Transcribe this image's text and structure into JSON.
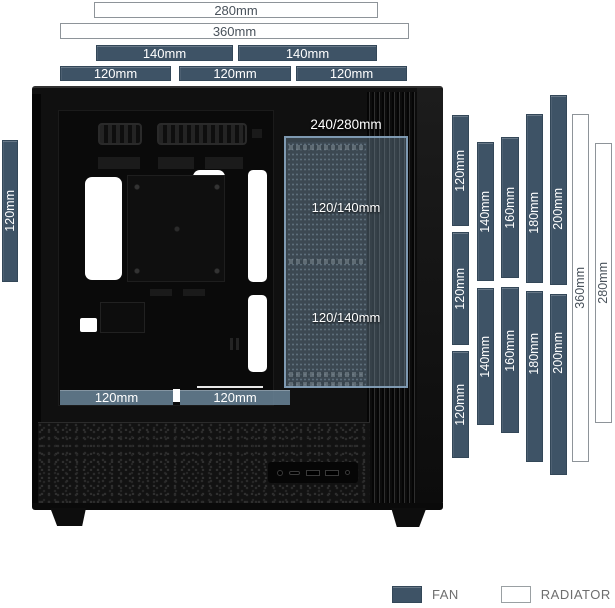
{
  "legend": {
    "fan_label": "FAN",
    "radiator_label": "RADIATOR"
  },
  "case_labels": {
    "side_radiator": "240/280mm",
    "side_fan_top": "120/140mm",
    "side_fan_bottom": "120/140mm"
  },
  "colors": {
    "fan_bar": "#3e5366",
    "radiator_border": "#8e9499",
    "bar_text_light": "#ffffff",
    "bar_text_dark": "#49525b",
    "overlay_tint": "rgba(124,152,173,0.38)",
    "legend_text": "#6e6e6e"
  },
  "dimension_bars": [
    {
      "label": "280mm",
      "kind": "radiator",
      "orient": "h",
      "x": 94,
      "y": 2,
      "w": 284,
      "h": 16,
      "area": "top"
    },
    {
      "label": "360mm",
      "kind": "radiator",
      "orient": "h",
      "x": 60,
      "y": 23,
      "w": 349,
      "h": 16,
      "area": "top"
    },
    {
      "label": "140mm",
      "kind": "fan",
      "orient": "h",
      "x": 96,
      "y": 45,
      "w": 137,
      "h": 16,
      "area": "top"
    },
    {
      "label": "140mm",
      "kind": "fan",
      "orient": "h",
      "x": 238,
      "y": 45,
      "w": 139,
      "h": 16,
      "area": "top"
    },
    {
      "label": "120mm",
      "kind": "fan",
      "orient": "h",
      "x": 60,
      "y": 66,
      "w": 111,
      "h": 15,
      "area": "top"
    },
    {
      "label": "120mm",
      "kind": "fan",
      "orient": "h",
      "x": 179,
      "y": 66,
      "w": 112,
      "h": 15,
      "area": "top"
    },
    {
      "label": "120mm",
      "kind": "fan",
      "orient": "h",
      "x": 296,
      "y": 66,
      "w": 111,
      "h": 15,
      "area": "top"
    },
    {
      "label": "120mm",
      "kind": "fan",
      "orient": "v",
      "x": 2,
      "y": 140,
      "w": 16,
      "h": 142,
      "area": "rear"
    },
    {
      "label": "120mm",
      "kind": "fan",
      "orient": "v",
      "x": 452,
      "y": 115,
      "w": 17,
      "h": 111,
      "area": "right"
    },
    {
      "label": "120mm",
      "kind": "fan",
      "orient": "v",
      "x": 452,
      "y": 232,
      "w": 17,
      "h": 113,
      "area": "right"
    },
    {
      "label": "120mm",
      "kind": "fan",
      "orient": "v",
      "x": 452,
      "y": 351,
      "w": 17,
      "h": 107,
      "area": "right"
    },
    {
      "label": "140mm",
      "kind": "fan",
      "orient": "v",
      "x": 477,
      "y": 142,
      "w": 17,
      "h": 139,
      "area": "right"
    },
    {
      "label": "140mm",
      "kind": "fan",
      "orient": "v",
      "x": 477,
      "y": 288,
      "w": 17,
      "h": 137,
      "area": "right"
    },
    {
      "label": "160mm",
      "kind": "fan",
      "orient": "v",
      "x": 501,
      "y": 137,
      "w": 18,
      "h": 141,
      "area": "right"
    },
    {
      "label": "160mm",
      "kind": "fan",
      "orient": "v",
      "x": 501,
      "y": 287,
      "w": 18,
      "h": 146,
      "shift": -9,
      "area": "right"
    },
    {
      "label": "180mm",
      "kind": "fan",
      "orient": "v",
      "x": 526,
      "y": 114,
      "w": 17,
      "h": 169,
      "shift": 14,
      "area": "right"
    },
    {
      "label": "180mm",
      "kind": "fan",
      "orient": "v",
      "x": 526,
      "y": 291,
      "w": 17,
      "h": 171,
      "shift": -23,
      "area": "right"
    },
    {
      "label": "200mm",
      "kind": "fan",
      "orient": "v",
      "x": 550,
      "y": 95,
      "w": 17,
      "h": 190,
      "shift": 19,
      "area": "right"
    },
    {
      "label": "200mm",
      "kind": "fan",
      "orient": "v",
      "x": 550,
      "y": 294,
      "w": 17,
      "h": 181,
      "shift": -32,
      "area": "right"
    },
    {
      "label": "360mm",
      "kind": "radiator",
      "orient": "v",
      "x": 572,
      "y": 114,
      "w": 17,
      "h": 348,
      "area": "right"
    },
    {
      "label": "280mm",
      "kind": "radiator",
      "orient": "v",
      "x": 595,
      "y": 143,
      "w": 17,
      "h": 280,
      "area": "right"
    }
  ],
  "case_bottom_bars": [
    {
      "label": "120mm",
      "x": 60,
      "y": 390,
      "w": 113,
      "h": 15
    },
    {
      "label": "120mm",
      "x": 180,
      "y": 390,
      "w": 110,
      "h": 15
    }
  ]
}
